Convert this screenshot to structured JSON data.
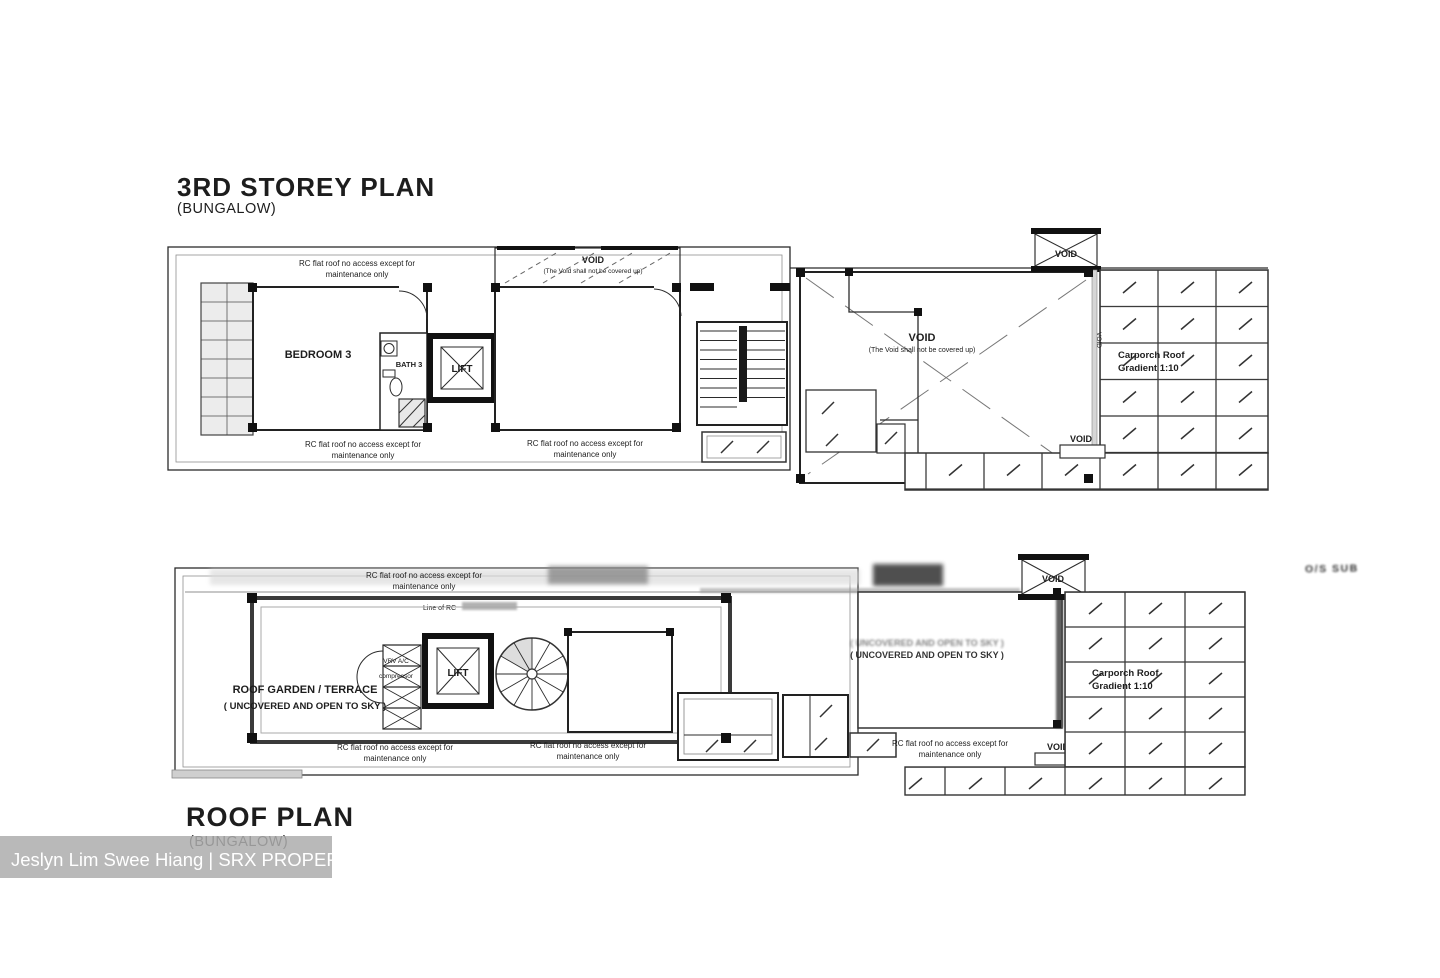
{
  "titles": {
    "plan1": "3RD STOREY PLAN",
    "plan1_sub": "(BUNGALOW)",
    "plan2": "ROOF PLAN",
    "plan2_sub": "(BUNGALOW)"
  },
  "notes": {
    "rc1": "RC flat roof no access except for",
    "rc2": "maintenance only",
    "void": "VOID",
    "void_note": "(The Void shall not be covered up)",
    "carporch1": "Carporch Roof",
    "carporch2": "Gradient 1:10",
    "line_of_rc": "Line of RC"
  },
  "rooms": {
    "bedroom3": "BEDROOM 3",
    "bath3": "BATH 3",
    "lift": "LIFT",
    "roof_garden1": "ROOF GARDEN / TERRACE",
    "roof_garden2": "( UNCOVERED AND OPEN TO SKY )",
    "uncovered": "( UNCOVERED AND OPEN TO SKY )",
    "vrv1": "VRV A/C",
    "vrv2": "compressor"
  },
  "watermark": {
    "text": "Jeslyn Lim Swee Hiang | SRX PROPERTY",
    "bg": "#adadad",
    "color": "#ffffff"
  },
  "stamp": {
    "text": "O/S SUB"
  },
  "colors": {
    "ink": "#222222",
    "paper": "#ffffff"
  }
}
